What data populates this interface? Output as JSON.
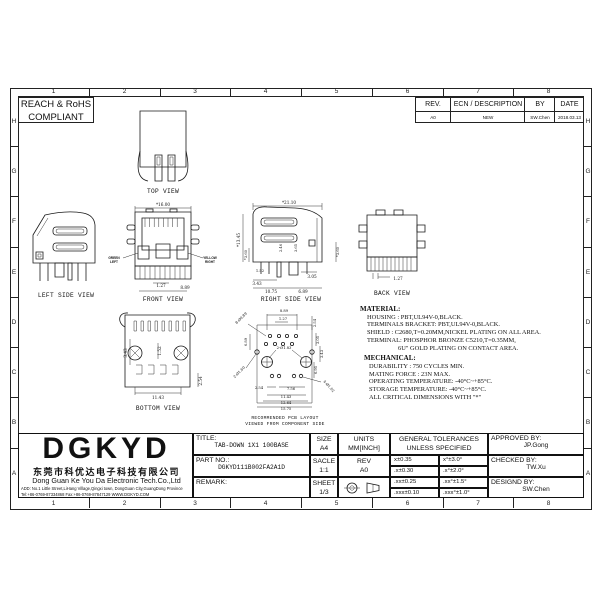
{
  "sheet": {
    "zones_top": [
      "1",
      "2",
      "3",
      "4",
      "5",
      "6",
      "7",
      "8"
    ],
    "zones_bottom": [
      "1",
      "2",
      "3",
      "4",
      "5",
      "6",
      "7",
      "8"
    ],
    "zones_left": [
      "H",
      "G",
      "F",
      "E",
      "D",
      "C",
      "B",
      "A"
    ],
    "zones_right": [
      "H",
      "G",
      "F",
      "E",
      "D",
      "C",
      "B",
      "A"
    ],
    "compliance_line1": "REACH & RoHS",
    "compliance_line2": "COMPLIANT"
  },
  "rev_table": {
    "col_rev": "REV.",
    "col_desc": "ECN / DESCRIPTION",
    "col_by": "BY",
    "col_date": "DATE",
    "row": {
      "rev": "A0",
      "desc": "NEW",
      "by": "SW.Chen",
      "date": "2018.03.13"
    }
  },
  "views": {
    "top": {
      "label": "TOP VIEW"
    },
    "left_side": {
      "label": "LEFT SIDE VIEW"
    },
    "front": {
      "label": "FRONT VIEW",
      "dim_width": "*16.00",
      "dim_pitch": "1.27",
      "dim_span": "8.89",
      "led_left_line1": "GREEN",
      "led_left_line2": "LEFT",
      "led_right_line1": "YELLOW",
      "led_right_line2": "RIGHT",
      "led_left_color": "#00dd00",
      "led_right_color": "#ffe600"
    },
    "right_side": {
      "label": "RIGHT SIDE VIEW",
      "dims": {
        "width": "*21.10",
        "height": "*13.45",
        "tail_left": "*3.60",
        "mid1": "2.46",
        "mid2": "3.65",
        "tail_right": "*3.60",
        "d305": "3.05",
        "d152": "1.52",
        "d343": "3.43",
        "d1075": "10.75",
        "d689": "6.89"
      }
    },
    "back": {
      "label": "BACK VIEW",
      "dim_pitch": "1.27"
    },
    "bottom": {
      "label": "BOTTOM VIEW",
      "dims": {
        "d343": "3.43",
        "d152": "1.52",
        "d1143": "11.43",
        "d254": "2.54"
      }
    },
    "pcb": {
      "label_line1": "RECOMMENDED PCB LAYOUT",
      "label_line2": "VIEWED FROM COMPONENT SIDE",
      "dims": {
        "d889": "8.89",
        "d127": "1.27",
        "d254a": "2.54",
        "holes8": "8-Ø0.89",
        "d689": "6.89",
        "holes2a": "2-Ø1.83",
        "d305": "3.05",
        "d343": "3.43",
        "d695": "6.95",
        "holes2b": "2-Ø1.60",
        "d254b": "2.54",
        "d756": "7.56",
        "d1143": "11.43",
        "d1264": "12.64",
        "d1575": "15.75",
        "holes4": "4-Ø1.02"
      }
    }
  },
  "notes": {
    "material_title": "MATERIAL:",
    "material_lines": [
      "HOUSING : PBT,UL94V-0,BLACK.",
      "TERMINALS BRACKET: PBT,UL94V-0,BLACK.",
      "SHIELD : C2680,T=0.20MM,NICKEL PLATING ON ALL AREA.",
      "TERMINAL: PHOSPHOR BRONZE C5210,T=0.35MM,",
      "6U\" GOLD PLATING ON CONTACT AREA."
    ],
    "mechanical_title": "MECHANICAL:",
    "mechanical_lines": [
      "DURABILITY : 750 CYCLES MIN.",
      "MATING FORCE : 23N MAX.",
      "OPERATING TEMPERATURE: -40°C~+85°C.",
      "STORAGE TEMPERATURE: -40°C~+85°C.",
      "ALL CRITICAL DIMENSIONS WITH \"*\""
    ]
  },
  "title_block": {
    "logo": "DGKYD",
    "company_cn": "东莞市科优达电子科技有限公司",
    "company_en": "Dong Guan Ke You Da Electronic Tech.Co.,Ltd",
    "address": "ADD: No.1 Little Street,LiHang Village,Qingxi town, DongGuan City,GuangDong Province",
    "contact": "Tel:+86-0769-87334868  Fax:+86-0769-87847129  WWW.DGKYD.COM",
    "title_label": "TITLE:",
    "title_value": "TAB-DOWN 1X1 100BASE",
    "part_label": "PART NO.:",
    "part_value": "DGKYD111B002FA2A1D",
    "remark_label": "REMARK:",
    "size_label": "SIZE",
    "size_value": "A4",
    "units_label": "UNITS",
    "units_value": "MM[INCH]",
    "tol_line1": "GENERAL TOLERANCES",
    "tol_line2": "UNLESS SPECIFIED",
    "approved_label": "APPROVED BY:",
    "approved_value": "JP.Gong",
    "scale_label": "SACLE",
    "scale_value": "1:1",
    "rev_label": "REV",
    "rev_value": "A0",
    "checked_label": "CHECKED BY:",
    "checked_value": "TW.Xu",
    "sheet_label": "SHEET",
    "sheet_value": "1/3",
    "designed_label": "DESIGND BY:",
    "designed_value": "SW.Chen",
    "tol_rows": [
      {
        "mm": "x±0.35",
        "deg": "x°±3.0°"
      },
      {
        "mm": ".x±0.30",
        "deg": ".x°±2.0°"
      },
      {
        "mm": ".xx±0.25",
        "deg": ".xx°±1.5°"
      },
      {
        "mm": ".xxx±0.10",
        "deg": ".xxx°±1.0°"
      }
    ]
  }
}
